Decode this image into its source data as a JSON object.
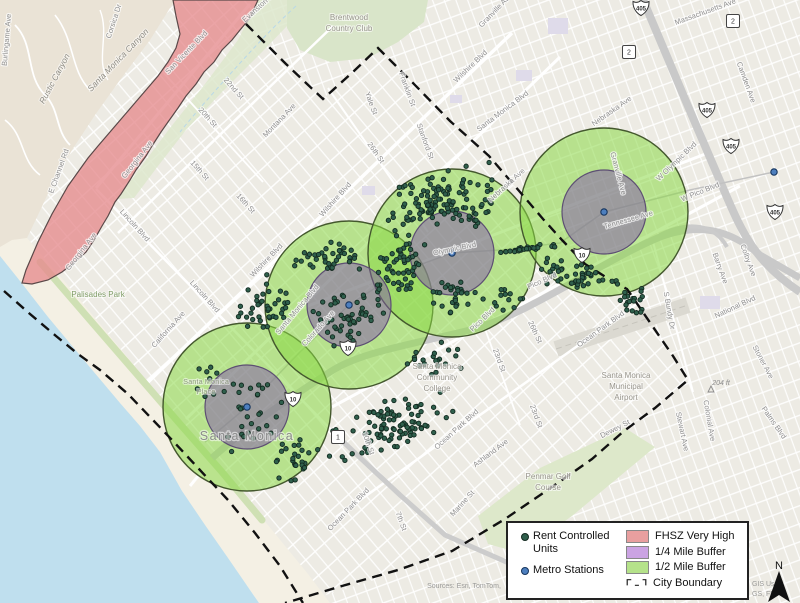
{
  "colors": {
    "land": "#edebe4",
    "ocean": "#bfdfee",
    "beach": "#f4f0e4",
    "parkfill": "#d9e5c9",
    "fhsz": "#E58A8D",
    "buffer_half": "#8BD946",
    "buffer_quarter": "#8155AE",
    "unit_dot": "#2F5F4C",
    "station_dot": "#4d7fbe",
    "boundary": "#111111"
  },
  "legend": {
    "left": [
      {
        "label": "Rent Controlled Units",
        "symbol": "unit-dot"
      },
      {
        "label": "Metro Stations",
        "symbol": "station-dot"
      }
    ],
    "right": [
      {
        "label": "FHSZ Very High",
        "color": "#E89F9F"
      },
      {
        "label": "1/4 Mile Buffer",
        "color": "#CBA3E3"
      },
      {
        "label": "1/2 Mile Buffer",
        "color": "#B5E28A"
      },
      {
        "label": "City Boundary",
        "color": "boundary"
      }
    ]
  },
  "map": {
    "north_label": "N",
    "radii": {
      "half": 84,
      "quarter": 42
    },
    "buffers": [
      [
        247,
        407
      ],
      [
        349,
        305
      ],
      [
        452,
        253
      ],
      [
        604,
        212
      ]
    ],
    "stations": [
      [
        247,
        407
      ],
      [
        349,
        305
      ],
      [
        452,
        253
      ],
      [
        604,
        212
      ],
      [
        774,
        172
      ]
    ],
    "shields": [
      [
        "i",
        "405",
        641,
        8
      ],
      [
        "i",
        "405",
        707,
        110
      ],
      [
        "i",
        "405",
        731,
        146
      ],
      [
        "i",
        "405",
        775,
        212
      ],
      [
        "i",
        "10",
        348,
        348
      ],
      [
        "i",
        "10",
        293,
        399
      ],
      [
        "i",
        "10",
        582,
        255
      ],
      [
        "s",
        "2",
        629,
        52
      ],
      [
        "s",
        "2",
        733,
        21
      ],
      [
        "s",
        "1",
        338,
        437
      ]
    ],
    "dot_clusters": [
      [
        438,
        198,
        62,
        30,
        -18,
        100
      ],
      [
        398,
        268,
        26,
        42,
        10,
        55
      ],
      [
        327,
        260,
        36,
        20,
        -15,
        40
      ],
      [
        262,
        306,
        34,
        26,
        -40,
        40
      ],
      [
        348,
        318,
        40,
        28,
        -10,
        50
      ],
      [
        388,
        428,
        72,
        30,
        -16,
        95
      ],
      [
        455,
        295,
        30,
        22,
        0,
        30
      ],
      [
        578,
        276,
        42,
        17,
        12,
        45
      ],
      [
        632,
        300,
        20,
        20,
        0,
        20
      ],
      [
        527,
        249,
        33,
        3,
        -8,
        28
      ],
      [
        247,
        408,
        50,
        48,
        0,
        30
      ],
      [
        300,
        458,
        28,
        22,
        -20,
        25
      ],
      [
        432,
        362,
        30,
        18,
        -15,
        22
      ],
      [
        208,
        380,
        12,
        26,
        0,
        8
      ],
      [
        470,
        215,
        25,
        15,
        -20,
        25
      ],
      [
        510,
        300,
        18,
        14,
        0,
        12
      ]
    ],
    "labels": [
      [
        "Rustic Canyon",
        57,
        80,
        -62,
        "canyon"
      ],
      [
        "Santa Monica Canyon",
        120,
        62,
        -46,
        "canyon"
      ],
      [
        "Corsica Dr",
        116,
        22,
        -72,
        "st"
      ],
      [
        "San Vicente Blvd",
        188,
        54,
        -46,
        "st"
      ],
      [
        "Burlingame Ave",
        9,
        40,
        -85,
        "st"
      ],
      [
        "E Channel Rd",
        61,
        172,
        -70,
        "st"
      ],
      [
        "Georgina Ave",
        139,
        161,
        -52,
        "st"
      ],
      [
        "Georgina Ave",
        83,
        253,
        -52,
        "st"
      ],
      [
        "Evanston St",
        260,
        9,
        -42,
        "st"
      ],
      [
        "Brentwood",
        349,
        20,
        0,
        "area"
      ],
      [
        "Country Club",
        349,
        31,
        0,
        "area"
      ],
      [
        "22nd St",
        232,
        90,
        48,
        "st"
      ],
      [
        "20th St",
        206,
        119,
        48,
        "st"
      ],
      [
        "15th St",
        198,
        172,
        48,
        "st"
      ],
      [
        "16th St",
        244,
        205,
        48,
        "st"
      ],
      [
        "Montana Ave",
        281,
        122,
        -46,
        "st"
      ],
      [
        "Lincoln Blvd",
        133,
        227,
        48,
        "st"
      ],
      [
        "Lincoln Blvd",
        203,
        298,
        48,
        "st"
      ],
      [
        "California Ave",
        170,
        331,
        -48,
        "st"
      ],
      [
        "Palisades Park",
        98,
        297,
        0,
        "park"
      ],
      [
        "Yale St",
        369,
        104,
        70,
        "st"
      ],
      [
        "Franklin St",
        405,
        90,
        70,
        "st"
      ],
      [
        "Stanford St",
        423,
        142,
        70,
        "st"
      ],
      [
        "Wilshire Blvd",
        472,
        68,
        -44,
        "st"
      ],
      [
        "Wilshire Blvd",
        337,
        201,
        -48,
        "st"
      ],
      [
        "Wilshire Blvd",
        268,
        262,
        -46,
        "st"
      ],
      [
        "Santa Monica Blvd",
        504,
        113,
        -37,
        "st"
      ],
      [
        "Santa Monica Blvd",
        299,
        311,
        -50,
        "st"
      ],
      [
        "26th St",
        374,
        154,
        55,
        "st"
      ],
      [
        "26th St",
        533,
        333,
        65,
        "st"
      ],
      [
        "Nebraska Ave",
        613,
        113,
        -35,
        "st"
      ],
      [
        "Nebraska Ave",
        508,
        187,
        -42,
        "st"
      ],
      [
        "Granville Ave",
        616,
        174,
        75,
        "st"
      ],
      [
        "Granville Ave",
        497,
        12,
        -46,
        "st"
      ],
      [
        "Tennessee Ave",
        629,
        222,
        -16,
        "st"
      ],
      [
        "W Olympic Blvd",
        678,
        163,
        -44,
        "st"
      ],
      [
        "W Pico Blvd",
        701,
        194,
        -22,
        "st"
      ],
      [
        "Olympic Blvd",
        455,
        251,
        -12,
        "st"
      ],
      [
        "Colorado Ave",
        320,
        330,
        -48,
        "st"
      ],
      [
        "Pico Blvd",
        543,
        283,
        -24,
        "st"
      ],
      [
        "Pico Blvd",
        484,
        321,
        -44,
        "st"
      ],
      [
        "Colby Ave",
        746,
        261,
        70,
        "st"
      ],
      [
        "Barry Ave",
        718,
        269,
        70,
        "st"
      ],
      [
        "S Bundy Dr",
        667,
        311,
        80,
        "st"
      ],
      [
        "National Blvd",
        736,
        309,
        -25,
        "st"
      ],
      [
        "Stoner Ave",
        761,
        363,
        62,
        "st"
      ],
      [
        "Colonial Ave",
        707,
        421,
        80,
        "st"
      ],
      [
        "Palms Blvd",
        772,
        424,
        55,
        "st"
      ],
      [
        "Stewart Ave",
        680,
        432,
        78,
        "st"
      ],
      [
        "Dewey St",
        616,
        431,
        -27,
        "st"
      ],
      [
        "Ocean Park Blvd",
        602,
        331,
        -36,
        "st"
      ],
      [
        "Ocean Park Blvd",
        458,
        431,
        -42,
        "st"
      ],
      [
        "Ocean Park Blvd",
        350,
        511,
        -46,
        "st"
      ],
      [
        "Ashland Ave",
        492,
        455,
        -37,
        "st"
      ],
      [
        "23rd St",
        497,
        361,
        70,
        "st"
      ],
      [
        "23rd St",
        534,
        417,
        70,
        "st"
      ],
      [
        "10th St",
        366,
        444,
        70,
        "st"
      ],
      [
        "7th St",
        399,
        522,
        70,
        "st"
      ],
      [
        "Marine St",
        464,
        505,
        -48,
        "st"
      ],
      [
        "Santa Monica",
        437,
        369,
        0,
        "area"
      ],
      [
        "Community",
        437,
        380,
        0,
        "area"
      ],
      [
        "College",
        437,
        391,
        0,
        "area"
      ],
      [
        "Penmar Golf",
        548,
        479,
        0,
        "area"
      ],
      [
        "Course",
        548,
        490,
        0,
        "area"
      ],
      [
        "Santa Monica",
        626,
        378,
        0,
        "area"
      ],
      [
        "Municipal",
        626,
        389,
        0,
        "area"
      ],
      [
        "Airport",
        626,
        400,
        0,
        "area"
      ],
      [
        "Santa Monica",
        247,
        440,
        0,
        "city"
      ],
      [
        "Santa Monica",
        206,
        384,
        0,
        "place"
      ],
      [
        "Place",
        206,
        394,
        0,
        "place"
      ],
      [
        "Camden Ave",
        744,
        83,
        70,
        "st"
      ],
      [
        "Massachusetts Ave",
        706,
        14,
        -20,
        "st"
      ],
      [
        "204 ft",
        721,
        385,
        0,
        "elev"
      ],
      [
        "Sources: Esri, TomTom,",
        464,
        588,
        0,
        "attr"
      ],
      [
        "GIS Us",
        752,
        586,
        0,
        "attr",
        "start"
      ],
      [
        "GS, FE",
        752,
        596,
        0,
        "attr",
        "start"
      ]
    ]
  }
}
